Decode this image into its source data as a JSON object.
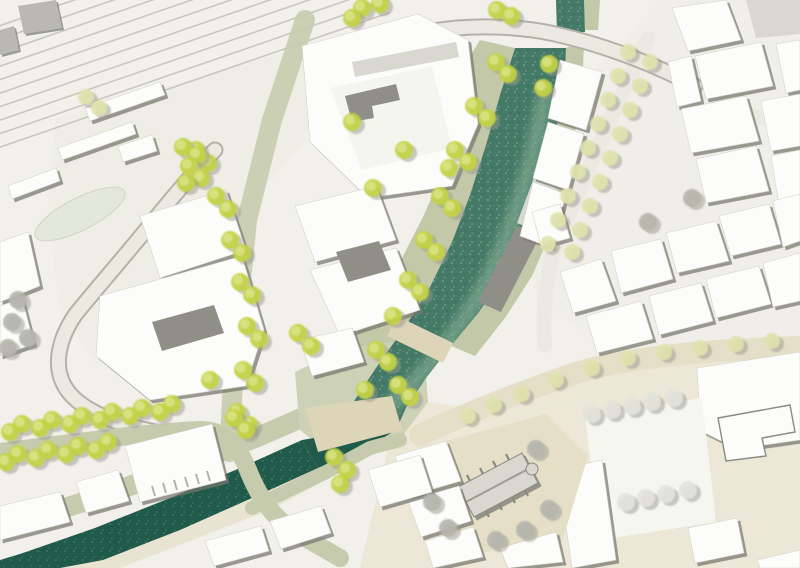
{
  "meta": {
    "viewbox": "0 0 800 568",
    "type": "site-plan"
  },
  "palette": {
    "paper": "#f1f0ea",
    "paper-light": "#eeeee6",
    "district": "#efeee8",
    "ground-beige": "#ebe6d4",
    "plaza-beige": "#e6dfc8",
    "bridge-beige": "#ddd5b8",
    "plaza-white": "#f6f6f1",
    "pond": "#e4e7db",
    "pond-edge": "#cfd4c3",
    "street-light": "#eaeae2",
    "street-sage": "#c6cbad",
    "plaza-sage": "#cdd1b6",
    "road-edge": "#b2b2a9",
    "bank-sage": "#c3c8a9",
    "water-dark": "#1f5a4b",
    "water-mid": "#447a67",
    "water-light": "#8fb49a",
    "bldg-white": "#fcfcfa",
    "bldg-offwhite": "#f5f5f0",
    "bldg-edge": "#d3d3cb",
    "roof-gray": "#d8d8d1",
    "roof-dark": "#8f8f87",
    "roof-charcoal": "#b9b9b1",
    "shadow": "#8a8a82",
    "rail": "#c7c7c0",
    "tree-green": "#c3d244",
    "tree-green-light": "#dce589",
    "tree-pale": "#dfe3ac",
    "tree-gray": "#b5b5ae",
    "tree-white": "#e3e3dc",
    "tree-shadow": "#98988f"
  },
  "railway": {
    "track_count": 10,
    "x": -30,
    "y0": 36,
    "dy": 13.5,
    "dx": 420,
    "drop": 145
  },
  "trees": {
    "shadow_offset": [
      4,
      3
    ],
    "groups": [
      {
        "name": "trees-proposed-green",
        "color": "tree-green",
        "inner": "tree-green-light",
        "r": 9,
        "points": [
          [
            196,
            150
          ],
          [
            208,
            163
          ],
          [
            216,
            196
          ],
          [
            228,
            209
          ],
          [
            230,
            240
          ],
          [
            242,
            253
          ],
          [
            240,
            282
          ],
          [
            252,
            295
          ],
          [
            247,
            326
          ],
          [
            259,
            339
          ],
          [
            243,
            370
          ],
          [
            255,
            383
          ],
          [
            237,
            412
          ],
          [
            249,
            425
          ],
          [
            183,
            147
          ],
          [
            197,
            155
          ],
          [
            189,
            166
          ],
          [
            201,
            178
          ],
          [
            186,
            183
          ],
          [
            362,
            8
          ],
          [
            380,
            4
          ],
          [
            352,
            18
          ],
          [
            497,
            10
          ],
          [
            511,
            16
          ],
          [
            496,
            62
          ],
          [
            508,
            74
          ],
          [
            474,
            106
          ],
          [
            487,
            118
          ],
          [
            455,
            150
          ],
          [
            468,
            162
          ],
          [
            440,
            196
          ],
          [
            452,
            208
          ],
          [
            424,
            240
          ],
          [
            436,
            252
          ],
          [
            408,
            280
          ],
          [
            420,
            292
          ],
          [
            393,
            316
          ],
          [
            376,
            350
          ],
          [
            388,
            362
          ],
          [
            365,
            390
          ],
          [
            549,
            64
          ],
          [
            543,
            88
          ],
          [
            352,
            122
          ],
          [
            404,
            150
          ],
          [
            449,
            168
          ],
          [
            373,
            188
          ],
          [
            298,
            333
          ],
          [
            311,
            346
          ],
          [
            10,
            432
          ],
          [
            22,
            424
          ],
          [
            40,
            428
          ],
          [
            52,
            420
          ],
          [
            70,
            424
          ],
          [
            82,
            416
          ],
          [
            100,
            420
          ],
          [
            112,
            412
          ],
          [
            130,
            416
          ],
          [
            142,
            408
          ],
          [
            160,
            412
          ],
          [
            172,
            404
          ],
          [
            6,
            462
          ],
          [
            18,
            454
          ],
          [
            36,
            458
          ],
          [
            48,
            450
          ],
          [
            66,
            454
          ],
          [
            78,
            446
          ],
          [
            96,
            450
          ],
          [
            108,
            442
          ],
          [
            234,
            418
          ],
          [
            246,
            430
          ],
          [
            210,
            380
          ],
          [
            334,
            457
          ],
          [
            347,
            470
          ],
          [
            340,
            484
          ],
          [
            398,
            385
          ],
          [
            410,
            397
          ]
        ]
      },
      {
        "name": "trees-young-pale",
        "color": "tree-pale",
        "inner": "",
        "r": 8,
        "points": [
          [
            628,
            52
          ],
          [
            618,
            76
          ],
          [
            608,
            100
          ],
          [
            598,
            124
          ],
          [
            588,
            148
          ],
          [
            578,
            172
          ],
          [
            568,
            196
          ],
          [
            558,
            220
          ],
          [
            548,
            244
          ],
          [
            650,
            62
          ],
          [
            640,
            86
          ],
          [
            630,
            110
          ],
          [
            620,
            134
          ],
          [
            610,
            158
          ],
          [
            600,
            182
          ],
          [
            590,
            206
          ],
          [
            580,
            230
          ],
          [
            572,
            252
          ],
          [
            468,
            416
          ],
          [
            494,
            405
          ],
          [
            522,
            394
          ],
          [
            556,
            380
          ],
          [
            592,
            368
          ],
          [
            628,
            358
          ],
          [
            664,
            352
          ],
          [
            700,
            348
          ],
          [
            736,
            344
          ],
          [
            772,
            341
          ],
          [
            86,
            97
          ],
          [
            99,
            108
          ]
        ]
      },
      {
        "name": "trees-existing-gray",
        "color": "tree-gray",
        "inner": "",
        "r": 9,
        "points": [
          [
            12,
            322
          ],
          [
            8,
            348
          ],
          [
            28,
            338
          ],
          [
            18,
            300
          ],
          [
            432,
            502
          ],
          [
            448,
            528
          ],
          [
            496,
            540
          ],
          [
            525,
            530
          ],
          [
            549,
            509
          ],
          [
            536,
            449
          ],
          [
            692,
            198
          ],
          [
            648,
            222
          ]
        ]
      },
      {
        "name": "trees-plaza-white",
        "color": "tree-white",
        "inner": "",
        "r": 9,
        "points": [
          [
            592,
            414
          ],
          [
            612,
            410
          ],
          [
            632,
            406
          ],
          [
            652,
            402
          ],
          [
            674,
            398
          ],
          [
            626,
            502
          ],
          [
            646,
            498
          ],
          [
            666,
            494
          ],
          [
            688,
            490
          ]
        ]
      }
    ]
  }
}
